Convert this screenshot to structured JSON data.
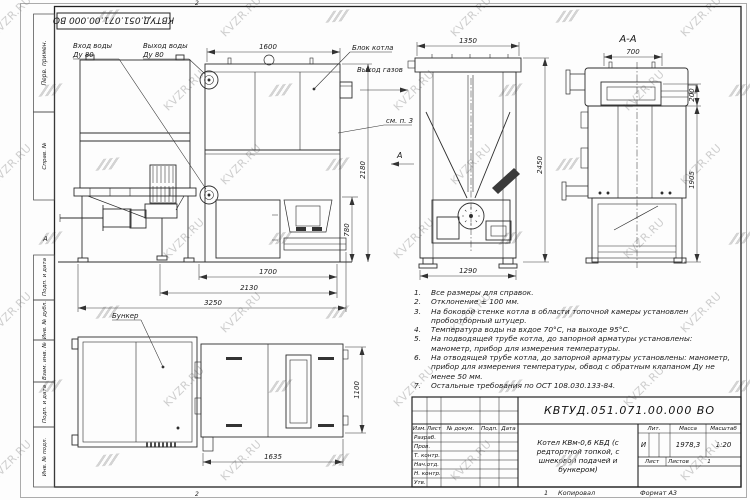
{
  "watermark": {
    "text": "KVZR.RU"
  },
  "sheet": {
    "top_stamp": "КВТУД.051.071.00.000 ВО",
    "zone_marker": "А",
    "fold_top": "2",
    "fold_bottom": "2",
    "margin_labels": {
      "perv": "Перв. примен.",
      "sprav": "Справ. №",
      "podp1": "Подп. и дата",
      "inv_dubl": "Инв. № дубл.",
      "vzam": "Взам. инв. №",
      "podp2": "Подп. и дата",
      "inv_podl": "Инв. № подл."
    },
    "copy_num": "1",
    "copied": "Копировал",
    "format": "Формат А3"
  },
  "side_view": {
    "inlet_1": "Вход воды",
    "inlet_2": "Ду 80",
    "outlet_1": "Выход воды",
    "outlet_2": "Ду 80",
    "block_label": "Блок котла",
    "gas_label": "Выход газов",
    "see_note": "см. п. 3",
    "dim_1600": "1600",
    "dim_2180": "2180",
    "dim_780": "780",
    "dim_1700": "1700",
    "dim_2130": "2130",
    "dim_3250": "3250"
  },
  "front_view": {
    "dim_1350": "1350",
    "dim_2450": "2450",
    "dim_1290": "1290",
    "section_letter": "А"
  },
  "section_view": {
    "title": "А-А",
    "dim_700": "700",
    "dim_200": "200",
    "dim_1905": "1905"
  },
  "plan_view": {
    "bunker_label": "Бункер",
    "dim_1635": "1635",
    "dim_1100": "1100"
  },
  "notes": [
    {
      "num": "1.",
      "text": "Все размеры для справок."
    },
    {
      "num": "2.",
      "text": "Отклонение ± 100 мм."
    },
    {
      "num": "3.",
      "text": "На боковой стенке котла в области топочной камеры установлен пробоотборный штуцер."
    },
    {
      "num": "4.",
      "text": "Температура воды на вхдое 70°С, на выходе 95°С."
    },
    {
      "num": "5.",
      "text": "На подводящей трубе котла, до запорной арматуры установлены: манометр, прибор для измерения температуры."
    },
    {
      "num": "6.",
      "text": "На отводящей трубе котла, до запорной арматуры установлены: манометр, прибор для измерения температуры, обвод с обратным клапаном Ду не менее 50 мм."
    },
    {
      "num": "7.",
      "text": "Остальные требования по ОСТ 108.030.133-84."
    }
  ],
  "title_block": {
    "designation": "КВТУД.051.071.00.000 ВО",
    "name": "Котел КВм-0,6 КБД (с редтортной топкой, с шнековой подачей и бункером)",
    "lit_header": "Лит.",
    "mass_header": "Масса",
    "scale_header": "Масштаб",
    "lit": "И",
    "mass": "1978,3",
    "scale": "1:20",
    "sheet_label": "Лист",
    "sheets_label": "Листов",
    "sheets_value": "1",
    "header_cols": [
      "Изм.",
      "Лист",
      "№ докум.",
      "Подп.",
      "Дата"
    ],
    "roles": [
      "Разраб.",
      "Пров.",
      "Т. контр.",
      "Нач.отд.",
      "Н. контр.",
      "Утв."
    ]
  }
}
